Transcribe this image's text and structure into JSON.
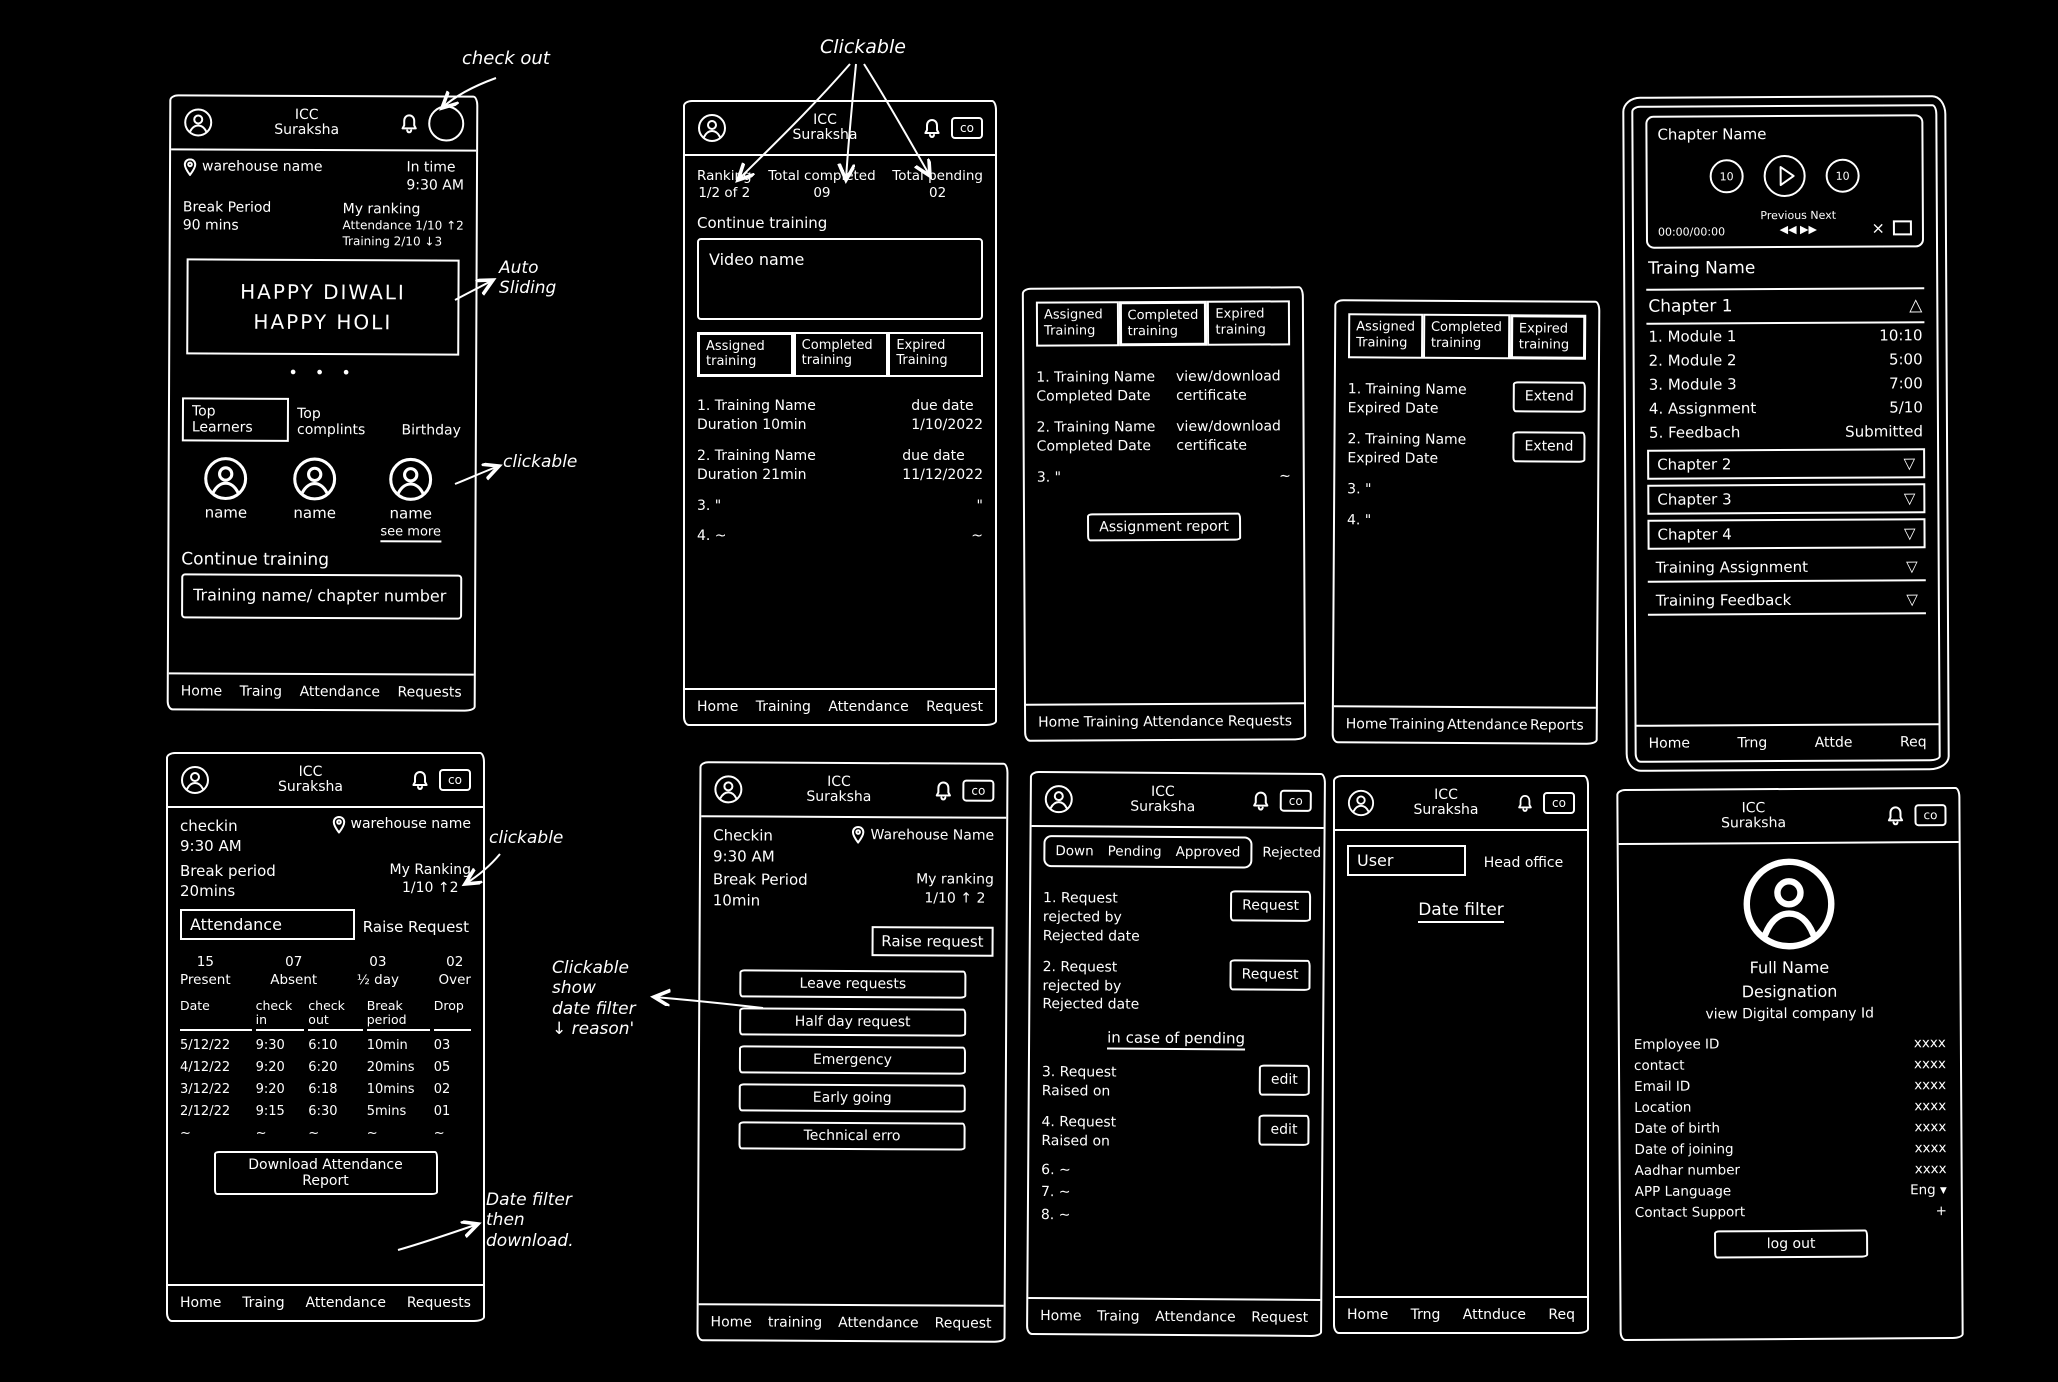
{
  "header": {
    "line1": "ICC",
    "line2": "Suraksha"
  },
  "glyphs": {
    "triangle_up": "△",
    "triangle_down": "▽",
    "carousel_dots": "•    •    •",
    "close": "×",
    "rewind": "◀◀",
    "forward": "▶▶",
    "id_badge": "co"
  },
  "annotations": {
    "check_out": "check out",
    "clickable_top": "Clickable",
    "auto_sliding_line1": "Auto",
    "auto_sliding_line2": "Sliding",
    "clickable_avatars": "clickable",
    "clickable_ranking": "clickable",
    "filter_line1": "Clickable",
    "filter_line2": "show",
    "filter_line3": "date filter",
    "filter_line4": "↓  reason'",
    "download_line1": "Date filter",
    "download_line2": "then",
    "download_line3": "download."
  },
  "screens": {
    "home": {
      "warehouse": "warehouse name",
      "in_time_label": "In time",
      "in_time_value": "9:30 AM",
      "break_label": "Break Period",
      "break_value": "90 mins",
      "ranking_title": "My ranking",
      "ranking_attendance": "Attendance 1/10 ↑2",
      "ranking_training": "Training 2/10 ↓3",
      "banner_line1": "HAPPY DIWALI",
      "banner_line2": "HAPPY HOLI",
      "tabs": [
        "Top Learners",
        "Top complints",
        "Birthday"
      ],
      "people": [
        {
          "name": "name"
        },
        {
          "name": "name"
        },
        {
          "name": "name"
        }
      ],
      "see_more": "see more",
      "continue_label": "Continue training",
      "training_card": "Training name/ chapter number",
      "nav": [
        "Home",
        "Traing",
        "Attendance",
        "Requests"
      ]
    },
    "training_assigned": {
      "stats": [
        {
          "label": "Ranking",
          "value": "1/2 of 2"
        },
        {
          "label": "Total completed",
          "value": "09"
        },
        {
          "label": "Total pending",
          "value": "02"
        }
      ],
      "continue_label": "Continue training",
      "video_card": "Video name",
      "tabs": [
        "Assigned training",
        "Completed training",
        "Expired Training"
      ],
      "rows": [
        {
          "l1": "1. Training Name",
          "l2": "Duration 10min",
          "r1": "due date",
          "r2": "1/10/2022"
        },
        {
          "l1": "2. Training Name",
          "l2": "Duration 21min",
          "r1": "due date",
          "r2": "11/12/2022"
        },
        {
          "l1": "3.        \"",
          "l2": "",
          "r1": "\"",
          "r2": ""
        },
        {
          "l1": "4.        ~",
          "l2": "",
          "r1": "~",
          "r2": ""
        }
      ],
      "nav": [
        "Home",
        "Training",
        "Attendance",
        "Request"
      ]
    },
    "training_completed": {
      "tabs": [
        "Assigned Training",
        "Completed training",
        "Expired training"
      ],
      "rows": [
        {
          "l1": "1. Training Name",
          "l2": "Completed Date",
          "action": "view/download certificate"
        },
        {
          "l1": "2. Training Name",
          "l2": "Completed Date",
          "action": "view/download certificate"
        },
        {
          "l1": "3.        \"",
          "l2": "",
          "action": "~"
        }
      ],
      "report_button": "Assignment report",
      "nav": [
        "Home",
        "Training",
        "Attendance",
        "Requests"
      ]
    },
    "training_expired": {
      "tabs": [
        "Assigned Training",
        "Completed training",
        "Expired training"
      ],
      "rows": [
        {
          "l1": "1. Training Name",
          "l2": "Expired Date",
          "action": "Extend"
        },
        {
          "l1": "2. Training Name",
          "l2": "Expired Date",
          "action": "Extend"
        },
        {
          "l1": "3.        \"",
          "l2": ""
        },
        {
          "l1": "4.        \"",
          "l2": ""
        }
      ],
      "nav": [
        "Home",
        "Training",
        "Attendance",
        "Reports"
      ]
    },
    "chapters": {
      "player": {
        "title": "Chapter Name",
        "rewind_badge": "10",
        "forward_badge": "10",
        "time": "00:00/00:00",
        "previous_label": "Previous",
        "next_label": "Next"
      },
      "training_name": "Traing Name",
      "chapter1": "Chapter 1",
      "modules": [
        {
          "name": "1. Module 1",
          "value": "10:10"
        },
        {
          "name": "2. Module 2",
          "value": "5:00"
        },
        {
          "name": "3. Module 3",
          "value": "7:00"
        },
        {
          "name": "4. Assignment",
          "value": "5/10"
        },
        {
          "name": "5. Feedbach",
          "value": "Submitted"
        }
      ],
      "collapsed": [
        "Chapter 2",
        "Chapter 3",
        "Chapter 4",
        "Training Assignment",
        "Training Feedback"
      ],
      "nav": [
        "Home",
        "Trng",
        "Attde",
        "Req"
      ]
    },
    "attendance": {
      "checkin_label": "checkin",
      "checkin_time": "9:30 AM",
      "warehouse": "warehouse name",
      "break_label": "Break period",
      "break_value": "20mins",
      "ranking_label": "My Ranking",
      "ranking_value": "1/10 ↑2",
      "tabs": [
        "Attendance",
        "Raise Request"
      ],
      "stats": [
        {
          "value": "15",
          "label": "Present"
        },
        {
          "value": "07",
          "label": "Absent"
        },
        {
          "value": "03",
          "label": "½ day"
        },
        {
          "value": "02",
          "label": "Over"
        }
      ],
      "table_headers": [
        "Date",
        "check in",
        "check out",
        "Break period",
        "Drop"
      ],
      "table_rows": [
        [
          "5/12/22",
          "9:30",
          "6:10",
          "10min",
          "03"
        ],
        [
          "4/12/22",
          "9:20",
          "6:20",
          "20mins",
          "05"
        ],
        [
          "3/12/22",
          "9:20",
          "6:18",
          "10mins",
          "02"
        ],
        [
          "2/12/22",
          "9:15",
          "6:30",
          "5mins",
          "01"
        ],
        [
          "~",
          "~",
          "~",
          "~",
          "~"
        ]
      ],
      "download_button": "Download Attendance Report",
      "nav": [
        "Home",
        "Traing",
        "Attendance",
        "Requests"
      ]
    },
    "raise_request": {
      "checkin_label": "Checkin",
      "checkin_time": "9:30 AM",
      "warehouse": "Warehouse Name",
      "break_label": "Break Period",
      "break_value": "10min",
      "ranking_label": "My ranking",
      "ranking_value": "1/10 ↑ 2",
      "tab": "Raise request",
      "buttons": [
        "Leave requests",
        "Half day request",
        "Emergency",
        "Early going",
        "Technical erro"
      ],
      "nav": [
        "Home",
        "training",
        "Attendance",
        "Request"
      ]
    },
    "request_status": {
      "tabs": [
        "Down",
        "Pending",
        "Approved",
        "Rejected"
      ],
      "items_rejected": [
        {
          "line1": "1. Request",
          "line2": "rejected by",
          "line3": "Rejected date",
          "action": "Request"
        },
        {
          "line1": "2. Request",
          "line2": "rejected by",
          "line3": "Rejected date",
          "action": "Request"
        }
      ],
      "pending_note": "in case of pending",
      "items_pending": [
        {
          "line1": "3. Request",
          "line2": "Raised on",
          "action": "edit"
        },
        {
          "line1": "4. Request",
          "line2": "Raised on",
          "action": "edit"
        }
      ],
      "extra": [
        "6.      ~",
        "7.      ~",
        "8.      ~"
      ],
      "nav": [
        "Home",
        "Traing",
        "Attendance",
        "Request"
      ]
    },
    "user_filter": {
      "tabs": [
        "User",
        "Head office"
      ],
      "date_filter": "Date filter",
      "nav": [
        "Home",
        "Trng",
        "Attnduce",
        "Req"
      ]
    },
    "profile": {
      "full_name": "Full Name",
      "designation": "Designation",
      "view_id": "view Digital company Id",
      "fields": [
        {
          "label": "Employee ID",
          "value": "xxxx"
        },
        {
          "label": "contact",
          "value": "xxxx"
        },
        {
          "label": "Email ID",
          "value": "xxxx"
        },
        {
          "label": "Location",
          "value": "xxxx"
        },
        {
          "label": "Date of birth",
          "value": "xxxx"
        },
        {
          "label": "Date of joining",
          "value": "xxxx"
        },
        {
          "label": "Aadhar number",
          "value": "xxxx"
        },
        {
          "label": "APP Language",
          "value": "Eng ▾"
        },
        {
          "label": "Contact Support",
          "value": "+"
        }
      ],
      "logout": "log out"
    }
  }
}
